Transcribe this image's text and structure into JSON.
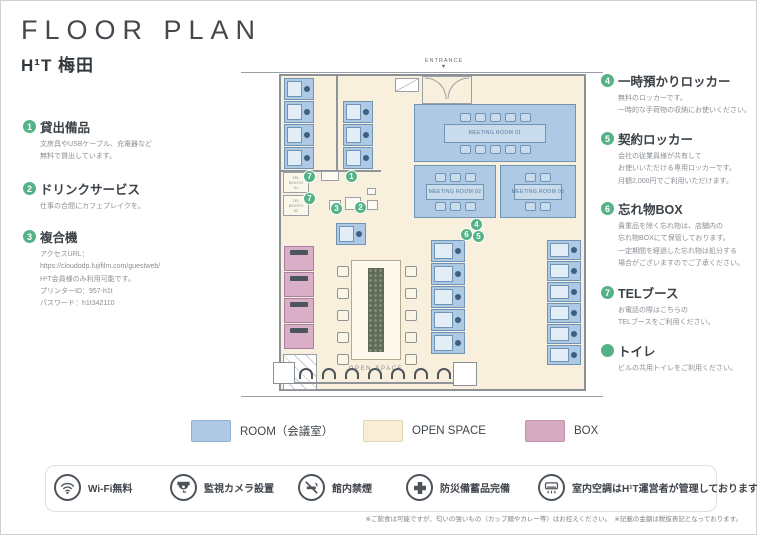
{
  "header": {
    "title": "FLOOR PLAN",
    "brand": "H¹T 梅田"
  },
  "left_items": [
    {
      "num": "1",
      "title": "貸出備品",
      "desc": "文房具やUSBケーブル、充電器など\n無料で貸出しています。"
    },
    {
      "num": "2",
      "title": "ドリンクサービス",
      "desc": "仕事の合間にカフェブレイクを。"
    },
    {
      "num": "3",
      "title": "複合機",
      "desc": "アクセスURL：\nhttps://cloudodp.fujifilm.com/guestweb/\nH¹T会員様のみ利用可能です。\nプリンターID：957-h1t\nパスワード：h1t342110"
    }
  ],
  "right_items": [
    {
      "num": "4",
      "title": "一時預かりロッカー",
      "desc": "無料のロッカーです。\n一時的な手荷物の収納にお使いください。"
    },
    {
      "num": "5",
      "title": "契約ロッカー",
      "desc": "会社の従業員様が共有して\nお使いいただける専用ロッカーです。\n月額2,000円でご利用いただけます。"
    },
    {
      "num": "6",
      "title": "忘れ物BOX",
      "desc": "貴重品を除く忘れ物は、店舗内の\n忘れ物BOXにて保管しております。\n一定期間を経過した忘れ物は処分する\n場合がございますのでご了承ください。"
    },
    {
      "num": "7",
      "title": "TELブース",
      "desc": "お電話の際はこちらの\nTELブースをご利用ください。"
    },
    {
      "num": "",
      "title": "トイレ",
      "desc": "ビルの共用トイレをご利用ください。"
    }
  ],
  "plan": {
    "entrance_label": "ENTRANCE",
    "entrance_arrow": "▼",
    "open_space_label": "OPEN SPACE",
    "rooms": {
      "meeting1": "MEETING ROOM 01",
      "meeting2": "MEETING ROOM 02",
      "meeting3": "MEETING ROOM 03",
      "tel1": "TEL\nBOOTH\n01",
      "tel2": "TEL\nBOOTH\n02"
    },
    "markers": [
      "7",
      "7",
      "1",
      "3",
      "2",
      "4",
      "6",
      "5"
    ]
  },
  "legend": [
    {
      "label": "ROOM（会議室）",
      "color": "#adc9e3"
    },
    {
      "label": "OPEN SPACE",
      "color": "#f8eed6"
    },
    {
      "label": "BOX",
      "color": "#d5abc2"
    }
  ],
  "amenities": [
    {
      "icon": "wifi",
      "label": "Wi-Fi無料"
    },
    {
      "icon": "camera",
      "label": "監視カメラ設置"
    },
    {
      "icon": "no-smoking",
      "label": "館内禁煙"
    },
    {
      "icon": "first-aid",
      "label": "防災備蓄品完備"
    },
    {
      "icon": "air-conditioner",
      "label": "室内空調はH¹T運営者が管理しております"
    }
  ],
  "footnote": "※ご飲食は可能ですが、匂いの強いもの（カップ麺やカレー等）はお控えください。　※記載の金額は税抜表記となっております。",
  "colors": {
    "room_blue": "#adc9e3",
    "open_space_cream": "#f8efdc",
    "box_pink": "#d5abc2",
    "marker_green": "#55b287",
    "wall_gray": "#8b9197",
    "text_dark": "#3f454b",
    "text_muted": "#8a8f94"
  }
}
